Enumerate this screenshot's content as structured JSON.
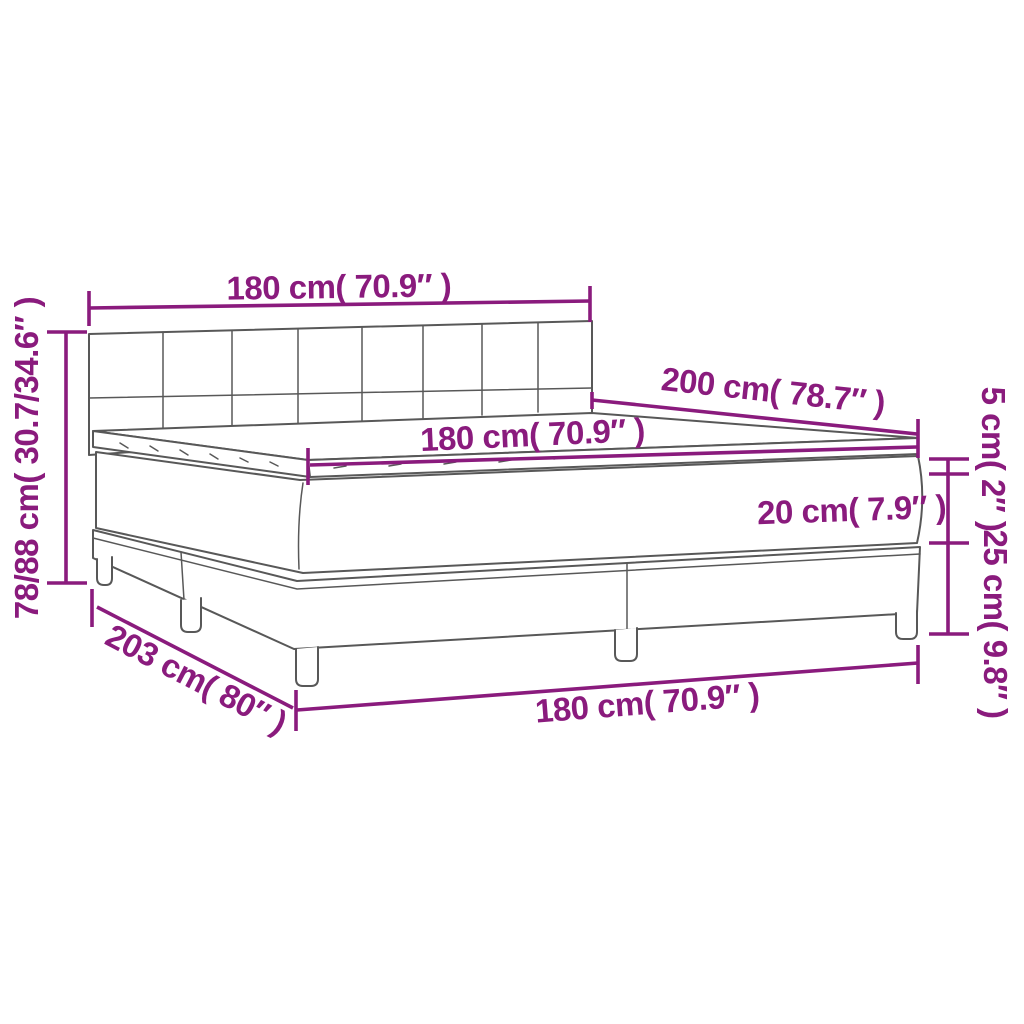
{
  "diagram": {
    "colors": {
      "dimension": "#8a1b7d",
      "outline": "#585858",
      "background": "#ffffff"
    },
    "labels": {
      "headboard_width": "180 cm( 70.9″ )",
      "height": "78/88 cm( 30.7/34.6″ )",
      "length": "200 cm( 78.7″ )",
      "mattress_width": "180 cm( 70.9″ )",
      "topper_thickness": "5 cm( 2″ )",
      "mattress_thickness": "20 cm( 7.9″ )",
      "base_height": "25 cm( 9.8″ )",
      "frame_length": "203 cm( 80″ )",
      "base_width": "180 cm( 70.9″ )"
    }
  }
}
